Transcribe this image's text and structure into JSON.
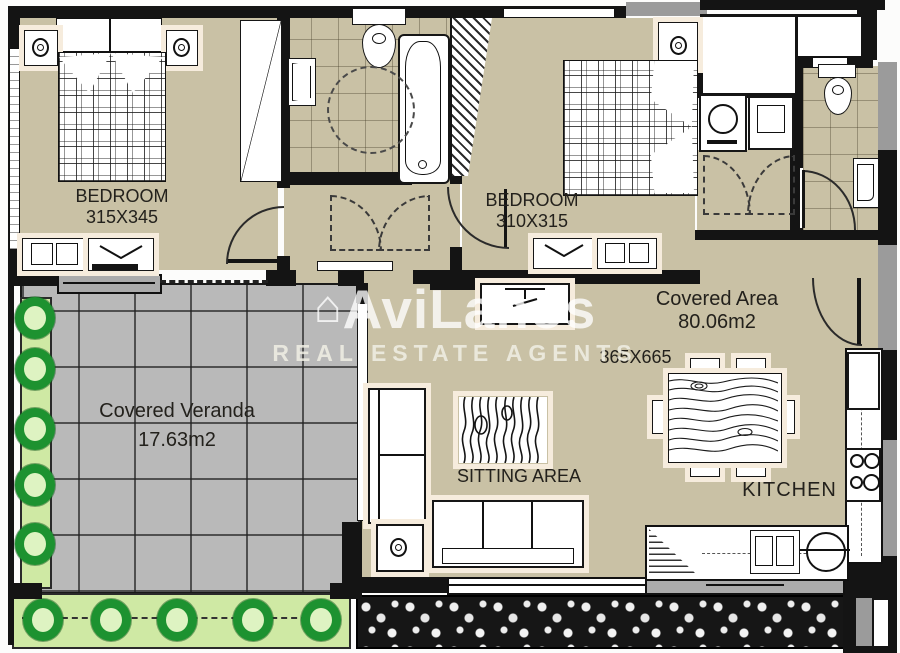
{
  "watermark": {
    "brand": "AviLanos",
    "tagline": "REAL ESTATE AGENTS"
  },
  "rooms": {
    "bedroom1": {
      "name": "BEDROOM",
      "dims": "315X345"
    },
    "bedroom2": {
      "name": "BEDROOM",
      "dims": "310X315"
    },
    "covered_area": {
      "name": "Covered Area",
      "area": "80.06m2",
      "dims": "365X665"
    },
    "veranda": {
      "name": "Covered Veranda",
      "area": "17.63m2"
    },
    "sitting": {
      "name": "SITTING AREA"
    },
    "kitchen": {
      "name": "KITCHEN"
    }
  },
  "colors": {
    "floor": "#c9c1a5",
    "tile": "#b9b9b9",
    "wall": "#141414",
    "planter": "#cfe9a4",
    "plant": "#1d9230",
    "halo": "#f6ecdd"
  }
}
